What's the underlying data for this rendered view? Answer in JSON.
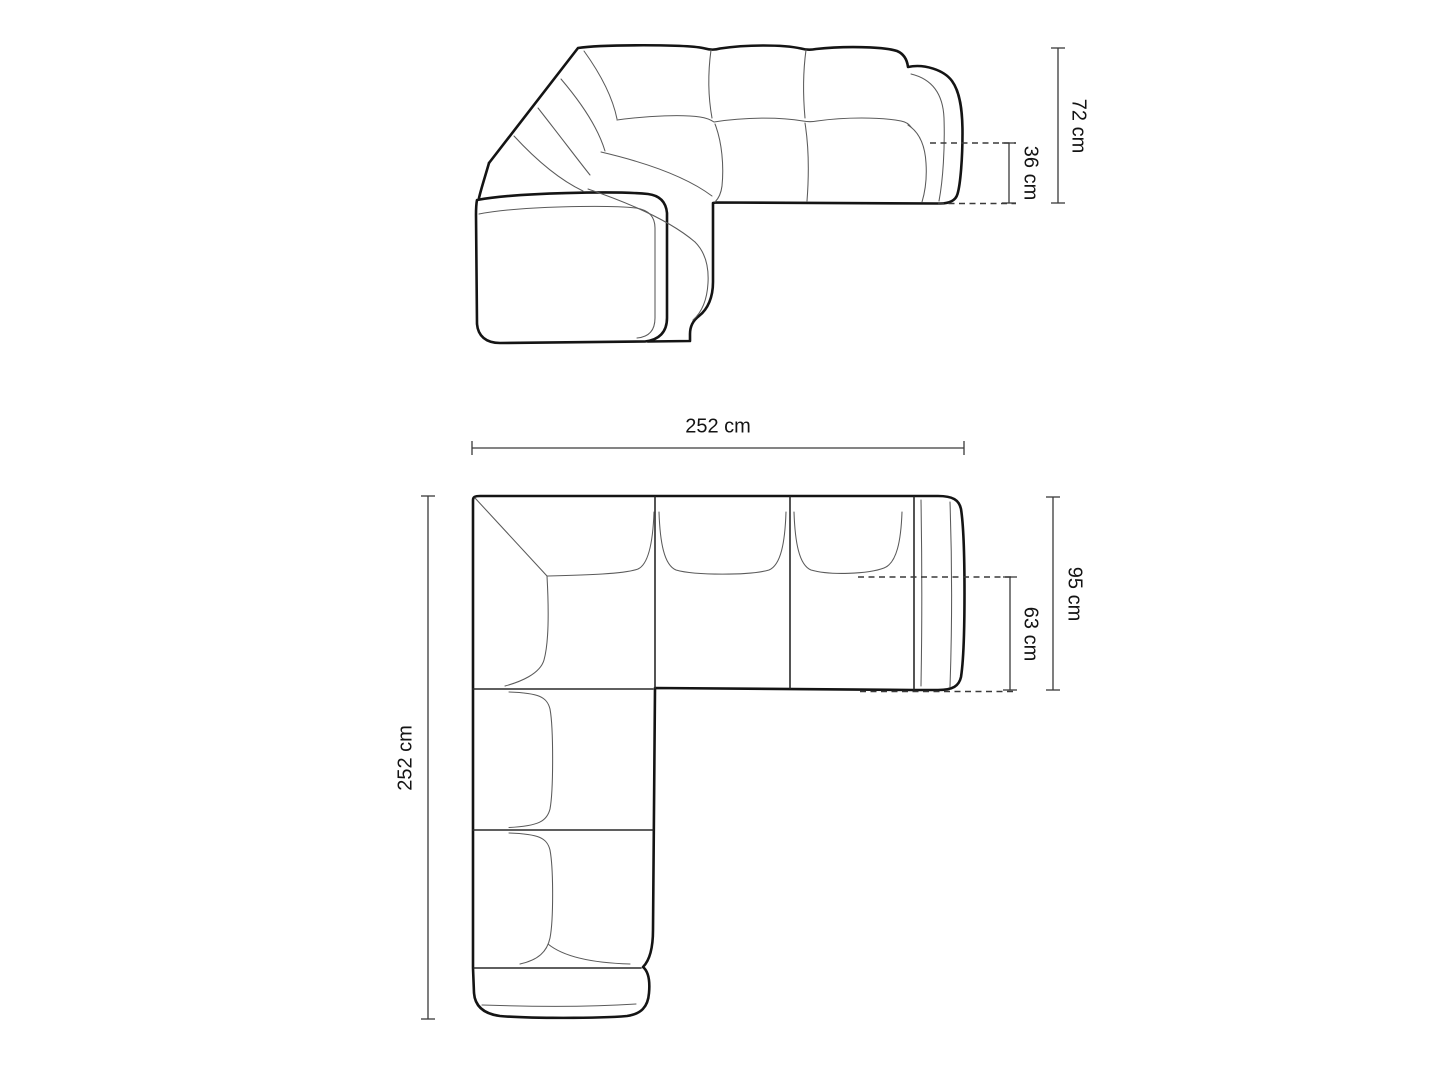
{
  "drawing": {
    "title": "corner-sofa-technical-drawing",
    "views": {
      "elevation": "side elevation view",
      "plan": "top plan view"
    }
  },
  "dimensions": {
    "overall_height": "72 cm",
    "seat_height": "36 cm",
    "overall_width": "252 cm",
    "overall_depth": "252 cm",
    "side_depth": "95 cm",
    "seat_depth": "63 cm"
  },
  "units": "cm",
  "colors": {
    "line_heavy": "#141414",
    "line_light": "#5a5a5a",
    "dimension_lines": "#3a3a3a",
    "background": "#ffffff"
  }
}
